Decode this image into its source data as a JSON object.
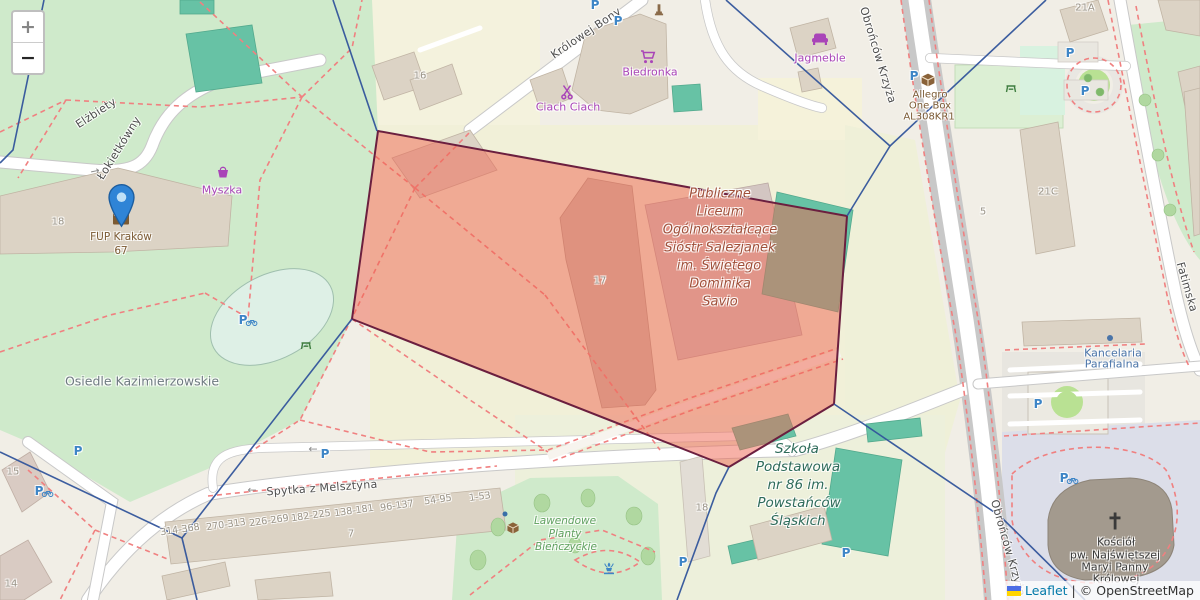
{
  "controls": {
    "zoom_in": "+",
    "zoom_out": "−"
  },
  "attribution": {
    "leaflet": "Leaflet",
    "separator": "|",
    "copyright": "© OpenStreetMap"
  },
  "streets": {
    "elzbiety_part1": "Elżbiety",
    "elzbiety_part2": "Łokietkówny",
    "spytka": "Spytka z Melsztyna",
    "krolowej_bony": "Królowej Bony",
    "obroncow_top": "Obrońców Krzyża",
    "obroncow_bottom": "Obrońców Krzyża",
    "fatimska": "Fatimska"
  },
  "pois": {
    "myszka": "Myszka",
    "biedronka": "Biedronka",
    "ciach_ciach": "Ciach Ciach",
    "jagmeble": "Jagmeble",
    "fup": {
      "name": "FUP Kraków",
      "number": "67"
    },
    "allegro": {
      "lines": [
        "Allegro",
        "One Box",
        "AL308KR1"
      ]
    },
    "kancelaria": {
      "lines": [
        "Kancelaria",
        "Parafialna"
      ]
    },
    "kosciol": {
      "lines": [
        "Kościół",
        "pw. Najświętszej",
        "Maryi Panny",
        "Królowej"
      ]
    },
    "liceum": {
      "lines": [
        "Publiczne",
        "Liceum",
        "Ogólnokształcące",
        "Sióstr Salezjanek",
        "im. Świętego",
        "Dominika",
        "Savio"
      ]
    },
    "szkola": {
      "lines": [
        "Szkoła",
        "Podstawowa",
        "nr 86 im.",
        "Powstańców",
        "Śląskich"
      ]
    },
    "lawendowe": {
      "lines": [
        "Lawendowe",
        "Planty",
        "Bieńczyckie"
      ]
    },
    "osiedle": "Osiedle Kazimierzowskie"
  },
  "house_numbers": {
    "b18": "18",
    "b16": "16",
    "b17": "17",
    "b21a": "21A",
    "b21c": "21C",
    "b5": "5",
    "b15": "15",
    "b14": "14",
    "b7": "7",
    "b18s": "18",
    "ranges": [
      "314-368",
      "270-313",
      "226-269",
      "182-225",
      "138-181",
      "96-137",
      "54-95",
      "1-53"
    ]
  },
  "symbols": {
    "parking": "P",
    "oneway_left": "←",
    "oneway_right": "→"
  },
  "overlay": {
    "polygon_points": "378,131 847,216 834,404 729,467 352,319",
    "polygon_fill": "#f06450",
    "polygon_stroke": "#6b1f3f",
    "boundary_color": "#31549b",
    "boundary_lines": [
      "44,0 13,150 0,163",
      "333,0 377,131",
      "726,0 890,146 847,216",
      "1046,0 890,146",
      "352,319 182,538",
      "182,538 0,452",
      "182,538 197,600",
      "834,404 1000,516 1085,600",
      "729,467 716,493 677,600"
    ]
  },
  "colors": {
    "marker_blue": "#2f84d6",
    "poi_purple": "#a944b8",
    "poi_brown": "#7b5a33",
    "parking_blue": "#3d85c6",
    "school_label": "#a0503a",
    "school2_label": "#2e6b5a",
    "park_label": "#5fa05f",
    "park_green": "#cfeacb",
    "building_gray": "#dcd3c5",
    "building_teal": "#67c2a5"
  }
}
